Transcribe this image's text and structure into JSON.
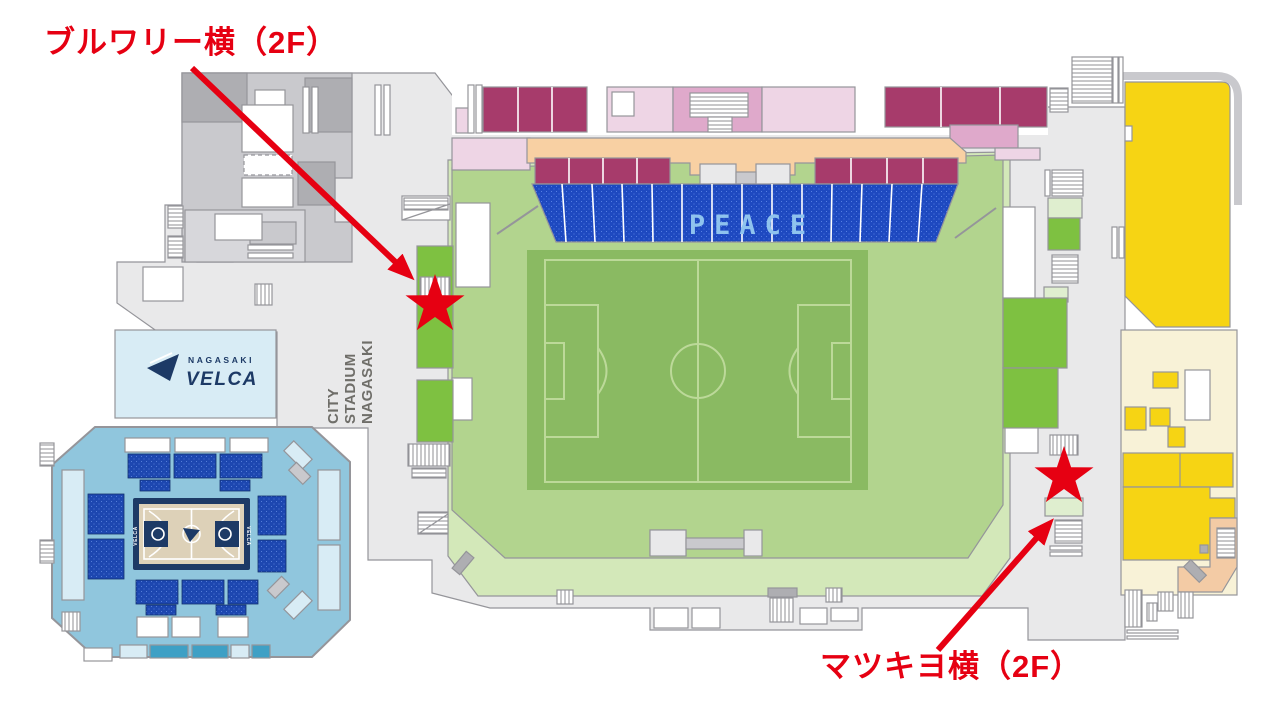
{
  "annotations": {
    "brewery": {
      "label": "ブルワリー横（2F）",
      "floor": "2F"
    },
    "matsukiyo": {
      "label": "マツキヨ横（2F）",
      "floor": "2F"
    }
  },
  "stadium": {
    "stand_text": "PEACE"
  },
  "arena_logo": {
    "top": "NAGASAKI",
    "main": "VELCA"
  },
  "site_logo": {
    "line1": "NAGASAKI",
    "line2": "STADIUM",
    "line3": "CITY"
  },
  "court": {
    "side_label": "VELCA"
  },
  "palette": {
    "annotation_red": "#e60012",
    "base_gray": "#e9e9ea",
    "line_gray": "#95959a",
    "building_gray": "#c9c9cd",
    "building_dark": "#aeaeb2",
    "building_light": "#d7d7db",
    "bowl_green": "#b2d48e",
    "apron_green": "#d3e8b9",
    "side_green": "#7ec141",
    "pale_green": "#dfeecf",
    "pitch_green": "#8aba62",
    "pitch_line": "#bcd999",
    "seat_blue": "#1e49c0",
    "peace_blue": "#8fc3ee",
    "maroon": "#a73b6b",
    "pink_pale": "#eed5e5",
    "pink_mid": "#dfa9cb",
    "peach": "#f8d0a3",
    "yellow": "#f6d414",
    "cream": "#f8f2d7",
    "salmon": "#f3cba5",
    "arena_blue": "#90c6dd",
    "arena_pale": "#d8ecf5",
    "arena_seat": "#1d47b0",
    "teal": "#3ea0c5",
    "navy": "#1d3a66",
    "court_tan": "#ddd1b8",
    "logo_gray": "#6f6e69"
  }
}
